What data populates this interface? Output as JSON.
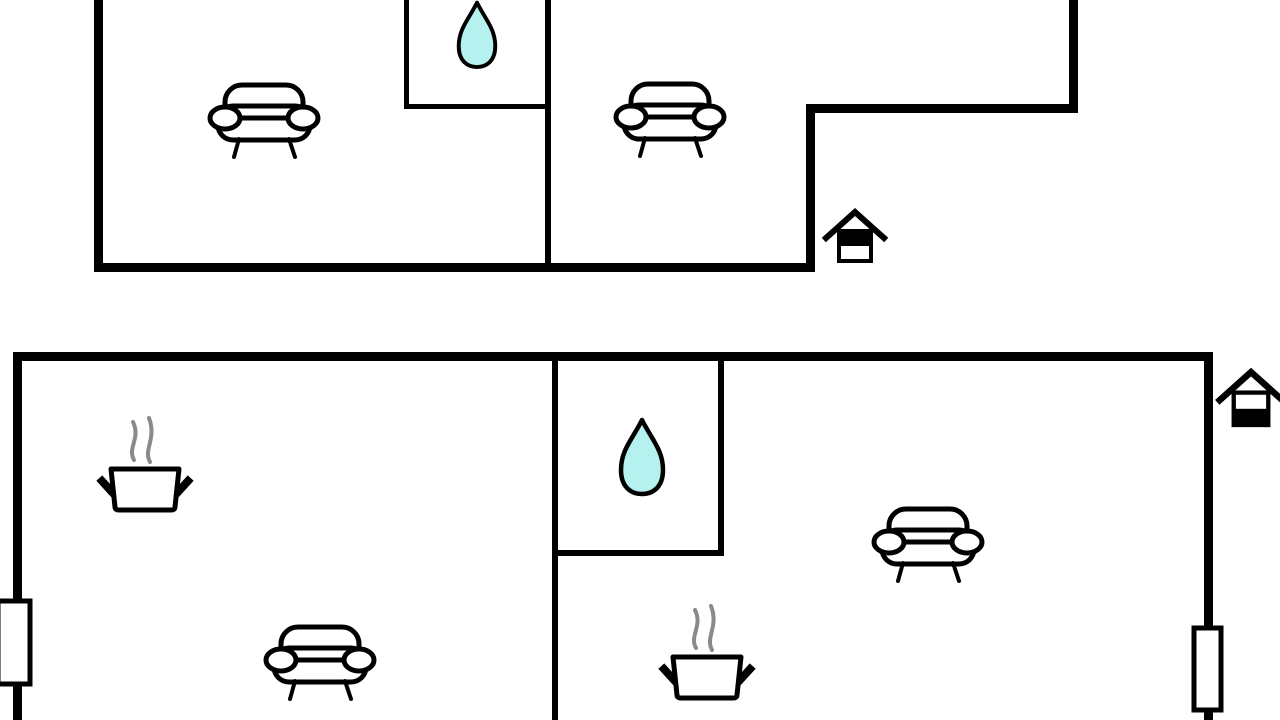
{
  "document": {
    "kind": "floor-plan-diagram",
    "plan_count": 2
  },
  "canvas": {
    "width": 1280,
    "height": 720,
    "background": "#ffffff"
  },
  "style": {
    "wall_color": "#000000",
    "icon_stroke": "#000000",
    "icon_fill": "#ffffff",
    "water_fill": "#b4f1ef",
    "steam_color": "#8a8a8a",
    "window_fill": "#ffffff"
  },
  "plans": [
    {
      "id": "upper-floor-plan",
      "walls_exterior": [
        {
          "name": "left-wall",
          "x": 94,
          "y": 0,
          "w": 9,
          "h": 272
        },
        {
          "name": "bottom-wall",
          "x": 94,
          "y": 263,
          "w": 721,
          "h": 9
        },
        {
          "name": "step-vertical",
          "x": 806,
          "y": 104,
          "w": 9,
          "h": 168
        },
        {
          "name": "step-horizontal",
          "x": 806,
          "y": 104,
          "w": 272,
          "h": 9
        },
        {
          "name": "right-wall",
          "x": 1069,
          "y": 0,
          "w": 9,
          "h": 113
        }
      ],
      "walls_interior": [
        {
          "name": "room-divider",
          "x": 545,
          "y": 0,
          "w": 6,
          "h": 263
        },
        {
          "name": "bathroom-left",
          "x": 404,
          "y": 0,
          "w": 5,
          "h": 109
        },
        {
          "name": "bathroom-bottom",
          "x": 404,
          "y": 104,
          "w": 147,
          "h": 5
        }
      ],
      "windows": [],
      "icons": [
        {
          "type": "sofa",
          "cx": 264,
          "cy": 120,
          "scale": 1
        },
        {
          "type": "sofa",
          "cx": 670,
          "cy": 119,
          "scale": 1
        },
        {
          "type": "water-drop",
          "cx": 477,
          "cy": 34,
          "scale": 0.87
        },
        {
          "type": "house-entrance",
          "cx": 855,
          "cy": 236,
          "scale": 1,
          "variant": "top-black"
        }
      ]
    },
    {
      "id": "lower-floor-plan",
      "walls_exterior": [
        {
          "name": "top-wall",
          "x": 13,
          "y": 352,
          "w": 1200,
          "h": 9
        },
        {
          "name": "left-wall",
          "x": 13,
          "y": 352,
          "w": 9,
          "h": 368
        },
        {
          "name": "right-wall",
          "x": 1204,
          "y": 352,
          "w": 9,
          "h": 368
        }
      ],
      "walls_interior": [
        {
          "name": "room-divider",
          "x": 552,
          "y": 361,
          "w": 6,
          "h": 359
        },
        {
          "name": "bathroom-right",
          "x": 718,
          "y": 361,
          "w": 6,
          "h": 195
        },
        {
          "name": "bathroom-bottom",
          "x": 552,
          "y": 550,
          "w": 172,
          "h": 6
        }
      ],
      "windows": [
        {
          "name": "left-window",
          "x": -2,
          "y": 601,
          "w": 32,
          "h": 83
        },
        {
          "name": "right-window",
          "x": 1194,
          "y": 628,
          "w": 27,
          "h": 82
        }
      ],
      "icons": [
        {
          "type": "cooking-pot",
          "cx": 145,
          "cy": 462,
          "scale": 1
        },
        {
          "type": "sofa",
          "cx": 320,
          "cy": 662,
          "scale": 1
        },
        {
          "type": "water-drop",
          "cx": 642,
          "cy": 456,
          "scale": 1
        },
        {
          "type": "cooking-pot",
          "cx": 707,
          "cy": 650,
          "scale": 1
        },
        {
          "type": "sofa",
          "cx": 928,
          "cy": 544,
          "scale": 1
        },
        {
          "type": "house-entrance",
          "cx": 1251,
          "cy": 398,
          "scale": 1.08,
          "variant": "bottom-black"
        }
      ]
    }
  ]
}
